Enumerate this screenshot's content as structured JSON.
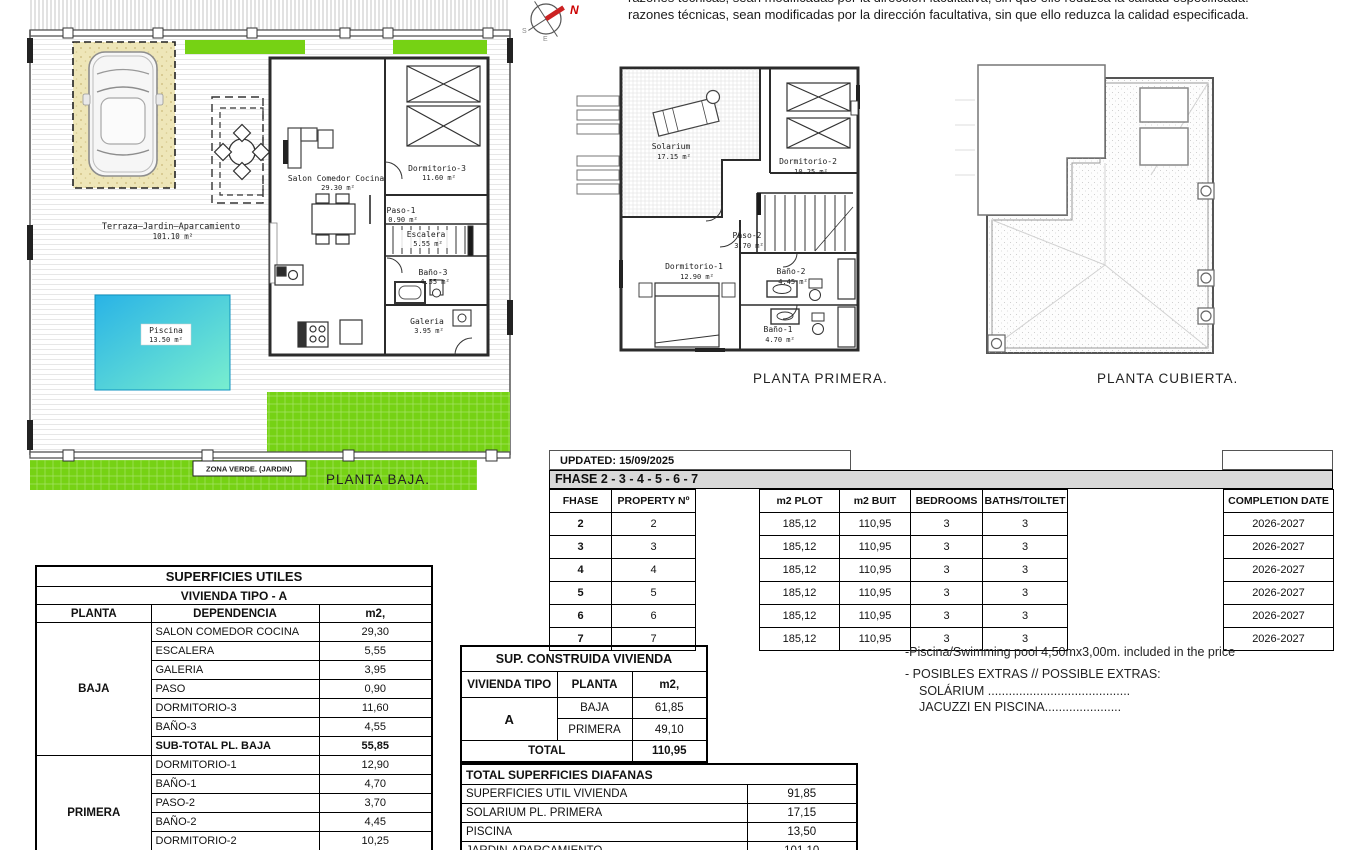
{
  "page": {
    "top_note_clipped": "razones técnicas, sean modificadas por la dirección facultativa, sin que ello reduzca la calidad especificada.",
    "top_note": "razones técnicas, sean modificadas por la dirección facultativa, sin que ello reduzca la calidad especificada.",
    "compass": {
      "north": "N",
      "south": "S",
      "east": "E"
    }
  },
  "plans": {
    "baja": {
      "title": "PLANTA BAJA.",
      "zone_label": "ZONA VERDE. (JARDIN)",
      "rooms": [
        {
          "name": "Terraza–Jardin–Aparcamiento",
          "area": "101.10 m²"
        },
        {
          "name": "Piscina",
          "area": "13.50 m²"
        },
        {
          "name": "Salon Comedor Cocina",
          "area": "29.30 m²"
        },
        {
          "name": "Dormitorio-3",
          "area": "11.60 m²"
        },
        {
          "name": "Paso-1",
          "area": "0.90 m²"
        },
        {
          "name": "Escalera",
          "area": "5.55 m²"
        },
        {
          "name": "Baño-3",
          "area": "4.55 m²"
        },
        {
          "name": "Galeria",
          "area": "3.95 m²"
        }
      ]
    },
    "primera": {
      "title": "PLANTA PRIMERA.",
      "rooms": [
        {
          "name": "Solarium",
          "area": "17.15 m²"
        },
        {
          "name": "Dormitorio-2",
          "area": "10.25 m²"
        },
        {
          "name": "Paso-2",
          "area": "3.70 m²"
        },
        {
          "name": "Dormitorio-1",
          "area": "12.90 m²"
        },
        {
          "name": "Baño-2",
          "area": "4.45 m²"
        },
        {
          "name": "Baño-1",
          "area": "4.70 m²"
        }
      ]
    },
    "cubierta": {
      "title": "PLANTA CUBIERTA."
    }
  },
  "phase_table": {
    "updated": "UPDATED: 15/09/2025",
    "title": "FHASE  2 - 3 - 4 - 5 - 6 - 7",
    "headers": [
      "FHASE",
      "PROPERTY Nº",
      "",
      "m2 PLOT",
      "m2 BUIT",
      "BEDROOMS",
      "BATHS/TOILTET",
      "",
      "COMPLETION DATE"
    ],
    "rows": [
      [
        "2",
        "2",
        "185,12",
        "110,95",
        "3",
        "3",
        "2026-2027"
      ],
      [
        "3",
        "3",
        "185,12",
        "110,95",
        "3",
        "3",
        "2026-2027"
      ],
      [
        "4",
        "4",
        "185,12",
        "110,95",
        "3",
        "3",
        "2026-2027"
      ],
      [
        "5",
        "5",
        "185,12",
        "110,95",
        "3",
        "3",
        "2026-2027"
      ],
      [
        "6",
        "6",
        "185,12",
        "110,95",
        "3",
        "3",
        "2026-2027"
      ],
      [
        "7",
        "7",
        "185,12",
        "110,95",
        "3",
        "3",
        "2026-2027"
      ]
    ]
  },
  "superficies_utiles": {
    "title": "SUPERFICIES UTILES",
    "subtitle": "VIVIENDA TIPO - A",
    "headers": [
      "PLANTA",
      "DEPENDENCIA",
      "m2,"
    ],
    "baja_label": "BAJA",
    "baja_rows": [
      [
        "SALON COMEDOR COCINA",
        "29,30"
      ],
      [
        "ESCALERA",
        "5,55"
      ],
      [
        "GALERIA",
        "3,95"
      ],
      [
        "PASO",
        "0,90"
      ],
      [
        "DORMITORIO-3",
        "11,60"
      ],
      [
        "BAÑO-3",
        "4,55"
      ]
    ],
    "baja_subtotal": [
      "SUB-TOTAL PL. BAJA",
      "55,85"
    ],
    "primera_label": "PRIMERA",
    "primera_rows": [
      [
        "DORMITORIO-1",
        "12,90"
      ],
      [
        "BAÑO-1",
        "4,70"
      ],
      [
        "PASO-2",
        "3,70"
      ],
      [
        "BAÑO-2",
        "4,45"
      ],
      [
        "DORMITORIO-2",
        "10,25"
      ]
    ],
    "primera_subtotal": [
      "SUB-TOTAL PL. PRIMERA",
      "36,00"
    ]
  },
  "sup_construida": {
    "title": "SUP. CONSTRUIDA VIVIENDA",
    "headers": [
      "VIVIENDA TIPO",
      "PLANTA",
      "m2,"
    ],
    "tipo": "A",
    "rows": [
      [
        "BAJA",
        "61,85"
      ],
      [
        "PRIMERA",
        "49,10"
      ]
    ],
    "total_label": "TOTAL",
    "total_value": "110,95"
  },
  "diafanas": {
    "title": "TOTAL SUPERFICIES DIAFANAS",
    "rows": [
      [
        "SUPERFICIES UTIL VIVIENDA",
        "91,85"
      ],
      [
        "SOLARIUM PL. PRIMERA",
        "17,15"
      ],
      [
        "PISCINA",
        "13,50"
      ],
      [
        "JARDIN-APARCAMIENTO",
        "101,10"
      ]
    ]
  },
  "notes": {
    "line1": "-Piscina/Swimming pool 4,50mx3,00m. included in the price",
    "line2": "- POSIBLES EXTRAS // POSSIBLE EXTRAS:",
    "line3": "SOLÁRIUM .........................................",
    "line4": "JACUZZI EN PISCINA......................"
  },
  "colors": {
    "green": "#76d214",
    "pool_gradient_start": "#29b3e6",
    "pool_gradient_end": "#79eecf",
    "sand": "#eee6b8",
    "table_header_gray": "#d9d9d9"
  }
}
